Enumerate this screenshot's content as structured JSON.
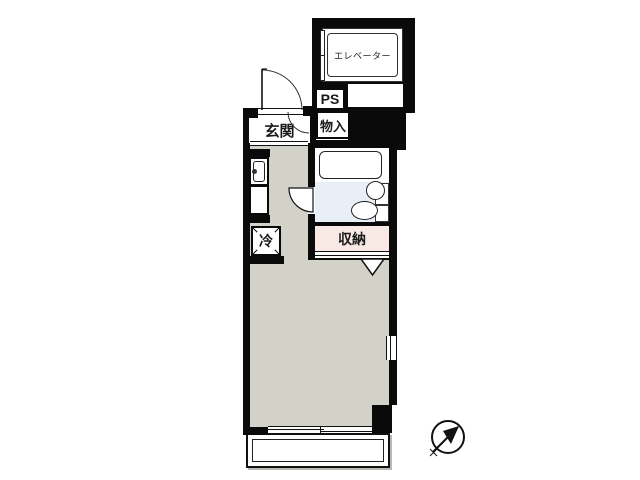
{
  "floorplan": {
    "labels": {
      "elevator": "エレベーター",
      "pipe_space": "PS",
      "entrance": "玄関",
      "hall_storage": "物入",
      "closet": "収納",
      "refrigerator": "冷"
    },
    "colors": {
      "wall": "#0a0a0a",
      "room_floor": "#d2d2c9",
      "bath_floor": "#e9eff6",
      "closet_floor": "#f8e9e4",
      "background": "#ffffff"
    },
    "compass": {
      "direction": "northeast"
    }
  }
}
